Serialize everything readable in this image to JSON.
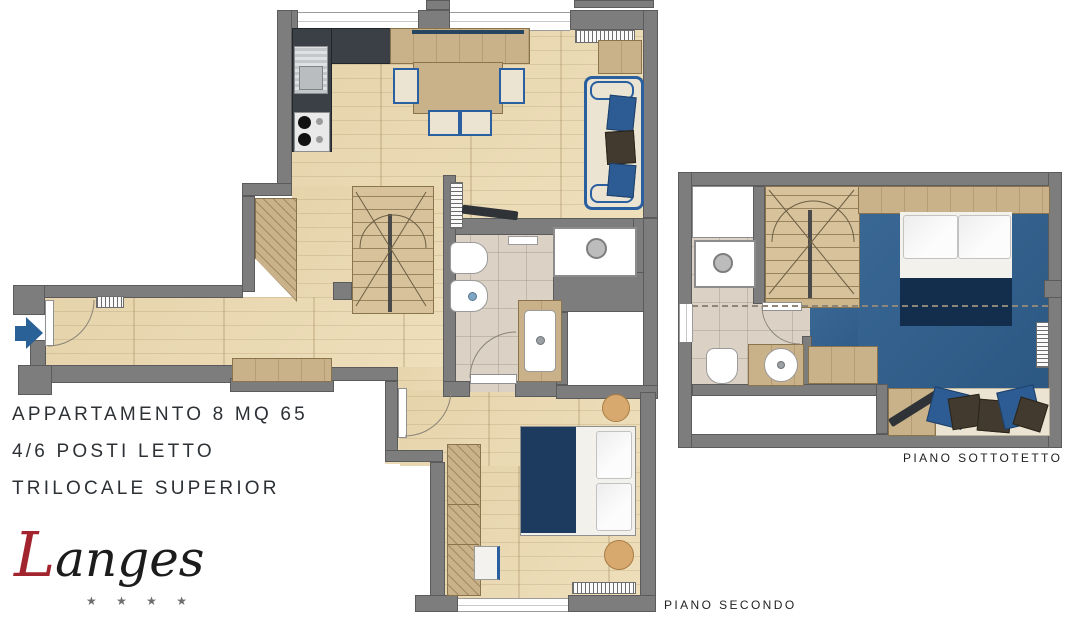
{
  "title_block": {
    "line1": "APPARTAMENTO 8 MQ 65",
    "line2": "4/6 POSTI LETTO",
    "line3": "TRILOCALE SUPERIOR"
  },
  "plans": {
    "secondo": {
      "label": "PIANO SECONDO"
    },
    "sottotetto": {
      "label": "PIANO SOTTOTETTO"
    }
  },
  "logo": {
    "initial": "L",
    "rest": "anges",
    "stars": "★ ★ ★ ★"
  },
  "icons": {
    "entrance_arrow": "right-arrow"
  },
  "colors": {
    "wall": "#7d7d7d",
    "wood_floor": "#ecdcb7",
    "tile_floor": "#dbd2c5",
    "carpet_blue": "#2f5f8e",
    "accent_blue": "#2a5fa0",
    "navy_textile": "#1d3a5f",
    "kitchen_counter": "#3a4045",
    "logo_red": "#a2242e"
  }
}
